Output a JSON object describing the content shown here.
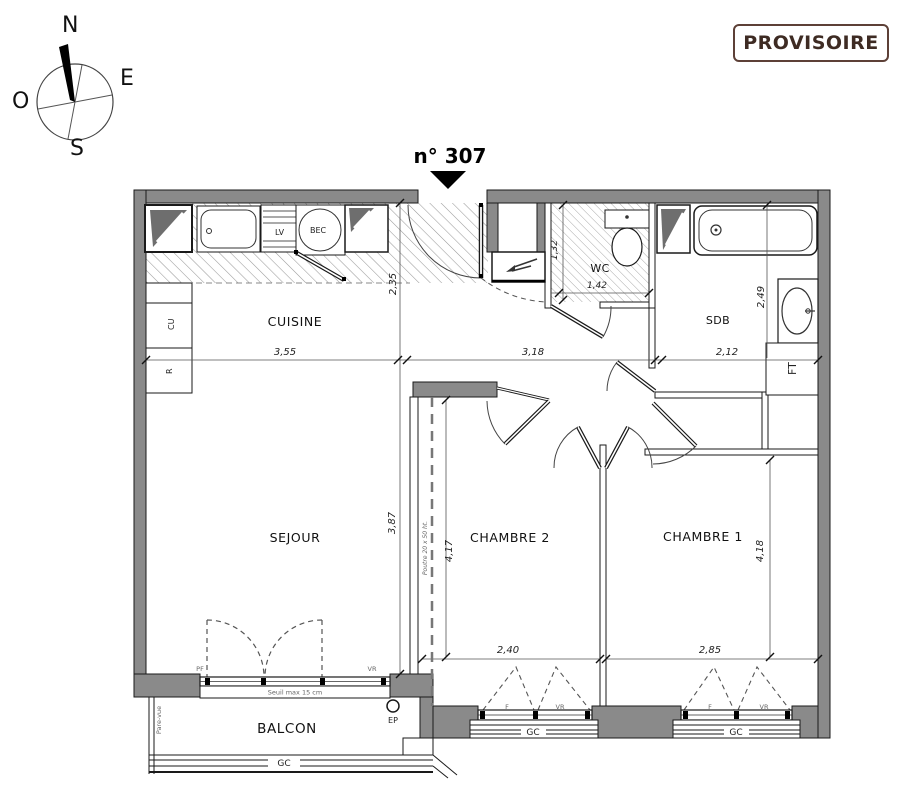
{
  "badge": {
    "label": "PROVISOIRE"
  },
  "title": {
    "number": "n° 307"
  },
  "compass": {
    "n": "N",
    "e": "E",
    "s": "S",
    "o": "O"
  },
  "rooms": {
    "cuisine": "CUISINE",
    "sejour": "SEJOUR",
    "chambre2": "CHAMBRE 2",
    "chambre1": "CHAMBRE 1",
    "wc": "WC",
    "sdb": "SDB",
    "balcon": "BALCON"
  },
  "fixtures": {
    "lv": "LV",
    "bec": "BEC",
    "cu": "CU",
    "r": "R",
    "ft": "FT"
  },
  "dimensions": {
    "cuisine_w": "3,55",
    "hall_w": "3,18",
    "sdb_w": "2,12",
    "cuisine_h": "2,35",
    "sejour_h": "3,87",
    "chambre2_h": "4,17",
    "chambre1_h": "4,18",
    "sdb_h": "2,49",
    "wc_h": "1,32",
    "wc_w": "1,42",
    "chambre2_win_w": "2,40",
    "chambre1_win_w": "2,85"
  },
  "annotations": {
    "poutre": "Poutre 20 x 50 ht.",
    "seuil": "Seuil max 15 cm",
    "pare_vue": "Pare-vue",
    "ep": "EP",
    "gc": "GC",
    "pf": "PF",
    "vr": "VR",
    "f": "F"
  }
}
